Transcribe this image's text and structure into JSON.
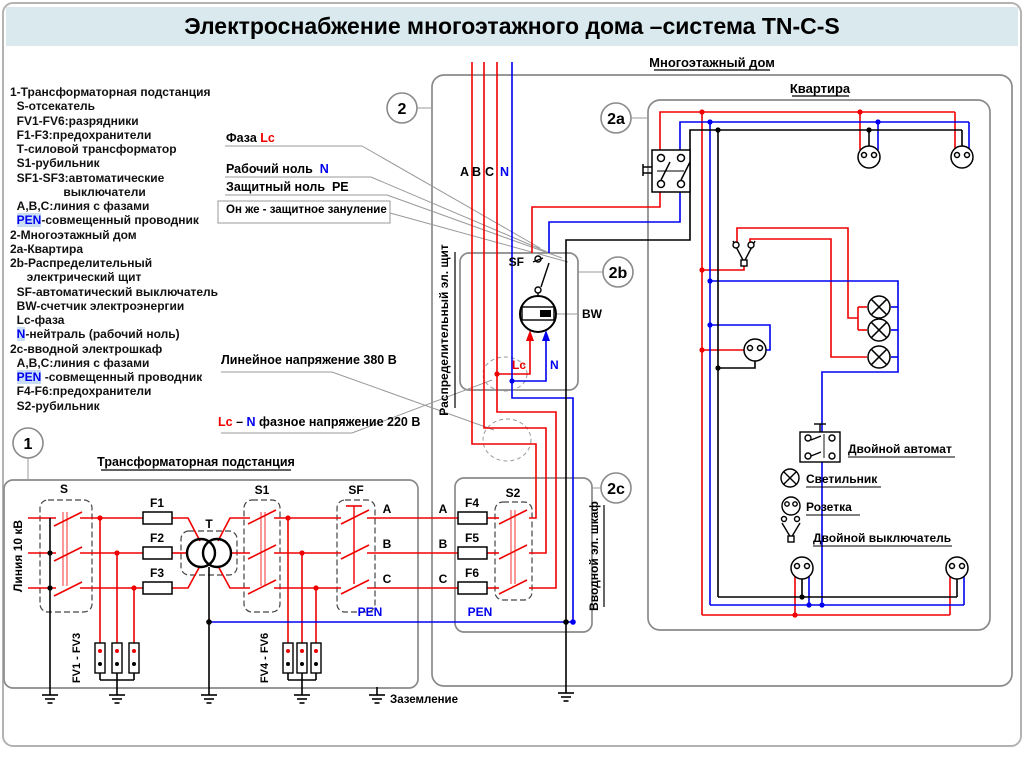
{
  "title": "Электроснабжение многоэтажного дома –система TN-C-S",
  "legend": {
    "lines": [
      [
        {
          "t": "1-Трансформаторная подстанция"
        }
      ],
      [
        {
          "t": "  S-отсекатель"
        }
      ],
      [
        {
          "t": "  FV1-FV6:разрядники"
        }
      ],
      [
        {
          "t": "  F1-F3:предохранители"
        }
      ],
      [
        {
          "t": "  Т-силовой трансформатор"
        }
      ],
      [
        {
          "t": "  S1-рубильник"
        }
      ],
      [
        {
          "t": "  SF1-SF3:автоматические"
        }
      ],
      [
        {
          "t": "                выключатели"
        }
      ],
      [
        {
          "t": "  А,В,С:линия с фазами"
        }
      ],
      [
        {
          "t": "  "
        },
        {
          "t": "PEN",
          "hl": true
        },
        {
          "t": "-совмещенный проводник"
        }
      ],
      [
        {
          "t": "2-Многоэтажный дом"
        }
      ],
      [
        {
          "t": "2а-Квартира"
        }
      ],
      [
        {
          "t": "2b-Распределительный"
        }
      ],
      [
        {
          "t": "     электрический щит"
        }
      ],
      [
        {
          "t": "  SF-автоматический выключатель"
        }
      ],
      [
        {
          "t": "  BW-счетчик электроэнергии"
        }
      ],
      [
        {
          "t": "  Lc-фаза"
        }
      ],
      [
        {
          "t": "  "
        },
        {
          "t": "N",
          "hl": true
        },
        {
          "t": "-нейтраль (рабочий ноль)"
        }
      ],
      [
        {
          "t": "2с-вводной электрошкаф"
        }
      ],
      [
        {
          "t": "  А,В,С:линия с фазами"
        }
      ],
      [
        {
          "t": "  "
        },
        {
          "t": "PEN",
          "hl": true
        },
        {
          "t": " -совмещенный проводник"
        }
      ],
      [
        {
          "t": "  F4-F6:предохранители"
        }
      ],
      [
        {
          "t": "  S2-рубильник"
        }
      ]
    ]
  },
  "callouts": [
    {
      "segments": [
        {
          "t": "Фаза "
        },
        {
          "t": "Lc",
          "c": "red"
        }
      ]
    },
    {
      "segments": [
        {
          "t": "Рабочий ноль  "
        },
        {
          "t": "N",
          "c": "blue"
        }
      ]
    },
    {
      "segments": [
        {
          "t": "Защитный ноль  PE"
        }
      ]
    },
    {
      "segments": [
        {
          "t": "Он же - защитное зануление"
        }
      ]
    },
    {
      "segments": [
        {
          "t": "Линейное напряжение 380 В"
        }
      ]
    },
    {
      "segments": [
        {
          "t": "Lc",
          "c": "red"
        },
        {
          "t": " – "
        },
        {
          "t": "N",
          "c": "blue"
        },
        {
          "t": " фазное напряжение 220 В"
        }
      ]
    }
  ],
  "markers": {
    "m1": "1",
    "m2": "2",
    "m2a": "2a",
    "m2b": "2b",
    "m2c": "2c"
  },
  "s": {
    "building": "Многоэтажный дом",
    "apartment": "Квартира",
    "substation": "Трансформаторная подстанция",
    "line10kv": "Линия 10 кВ",
    "dist_panel": "Распределительный эл. щит",
    "input_cabinet": "Вводной эл. шкаф",
    "grounding": "Заземление",
    "pen": "PEN",
    "s_label": "S",
    "s1": "S1",
    "s2": "S2",
    "sf": "SF",
    "t": "T",
    "f1": "F1",
    "f2": "F2",
    "f3": "F3",
    "f4": "F4",
    "f5": "F5",
    "f6": "F6",
    "fv13": "FV1 - FV3",
    "fv46": "FV4 - FV6",
    "a": "A",
    "b": "B",
    "c": "C",
    "n": "N",
    "lc": "Lc",
    "bw": "BW"
  },
  "apt_legend": {
    "breaker": "Двойной автомат",
    "lamp": "Светильник",
    "socket": "Розетка",
    "switch": "Двойной выключатель"
  }
}
